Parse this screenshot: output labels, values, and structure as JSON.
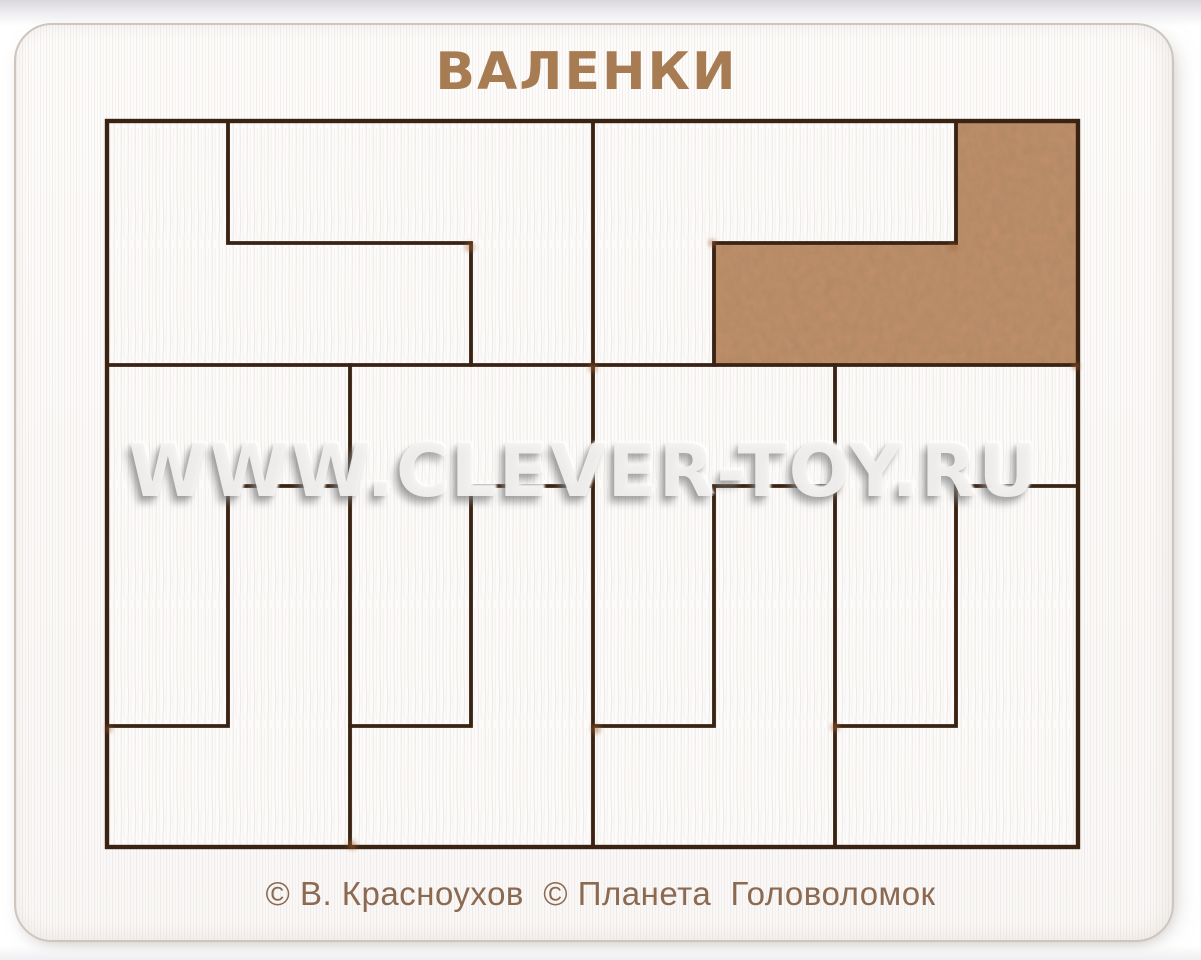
{
  "product": {
    "title": "ВАЛЕНКИ",
    "copyright": "© В. Красноухов  © Планета  Головоломок",
    "watermark": "WWW.CLEVER-TOY.RU"
  },
  "colors": {
    "page_background": "#ffffff",
    "board_white": "#fcfbfa",
    "engraving": "#3a2313",
    "title_brown": "#a87c52",
    "copyright_brown": "#8b6a51",
    "mdf_brown": "#bf8e6a",
    "burn_mark": "#a96230"
  },
  "puzzle": {
    "grid": {
      "columns": 8,
      "rows": 6,
      "cell_px": 121
    },
    "tray": {
      "x": 107,
      "y": 121,
      "width": 971,
      "height": 726
    },
    "piece_count": 12,
    "piece_shape": "L-tetromino boot (valenok)",
    "pieces": [
      {
        "id": "A",
        "color": "white",
        "points": "107,121 228,121 228,243 471,243 471,365 107,365"
      },
      {
        "id": "B",
        "color": "white",
        "points": "228,121 593,121 593,365 471,365 471,243 228,243"
      },
      {
        "id": "G",
        "color": "white",
        "points": "593,121 956,121 956,243 714,243 714,365 593,365"
      },
      {
        "id": "H",
        "color": "brown",
        "points": "956,121 1078,121 1078,365 714,365 714,243 956,243"
      },
      {
        "id": "C",
        "color": "white",
        "points": "107,365 350,365 350,486 228,486 228,726 107,726"
      },
      {
        "id": "D",
        "color": "white",
        "points": "107,726 228,726 228,486 350,486 350,847 107,847"
      },
      {
        "id": "E",
        "color": "white",
        "points": "350,365 593,365 593,486 471,486 471,726 350,726"
      },
      {
        "id": "F",
        "color": "white",
        "points": "350,726 471,726 471,486 593,486 593,847 350,847"
      },
      {
        "id": "I",
        "color": "white",
        "points": "593,365 835,365 835,486 714,486 714,726 593,726"
      },
      {
        "id": "J",
        "color": "white",
        "points": "593,726 714,726 714,486 835,486 835,847 593,847"
      },
      {
        "id": "K",
        "color": "white",
        "points": "835,365 1078,365 1078,486 956,486 956,726 835,726"
      },
      {
        "id": "L",
        "color": "white",
        "points": "835,726 956,726 956,486 1078,486 1078,847 835,847"
      }
    ]
  }
}
